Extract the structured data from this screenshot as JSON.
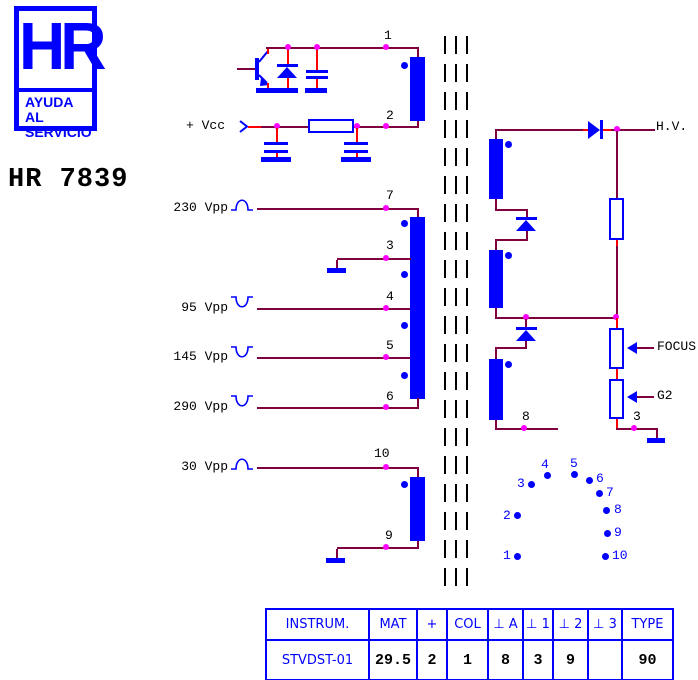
{
  "logo": {
    "monogram": "HR",
    "tagline1": "AYUDA AL",
    "tagline2": "SERVICIO"
  },
  "title": "HR 7839",
  "schematic": {
    "vcc": "+ Vcc",
    "hv": "H.V.",
    "focus": "FOCUS",
    "g2": "G2",
    "waveforms": {
      "w230": "230 Vpp",
      "w95": "95 Vpp",
      "w145": "145 Vpp",
      "w290": "290 Vpp",
      "w30": "30 Vpp"
    },
    "pins": {
      "p1": "1",
      "p2": "2",
      "p3": "3",
      "p4": "4",
      "p5": "5",
      "p6": "6",
      "p7": "7",
      "p8": "8",
      "p9": "9",
      "p10": "10",
      "p3b": "3"
    }
  },
  "pin_diagram": {
    "labels": [
      "1",
      "2",
      "3",
      "4",
      "5",
      "6",
      "7",
      "8",
      "9",
      "10"
    ]
  },
  "table": {
    "headers": [
      "INSTRUM.",
      "MAT",
      "+",
      "COL",
      "⊥ A",
      "⊥ 1",
      "⊥ 2",
      "⊥ 3",
      "TYPE"
    ],
    "row": [
      "STVDST-01",
      "29.5",
      "2",
      "1",
      "8",
      "3",
      "9",
      "",
      "90"
    ]
  },
  "colors": {
    "component_blue": "#0000ff",
    "wire_maroon": "#800040",
    "lead_red": "#ff0000",
    "junction_magenta": "#ff00ff",
    "text_black": "#000000"
  }
}
